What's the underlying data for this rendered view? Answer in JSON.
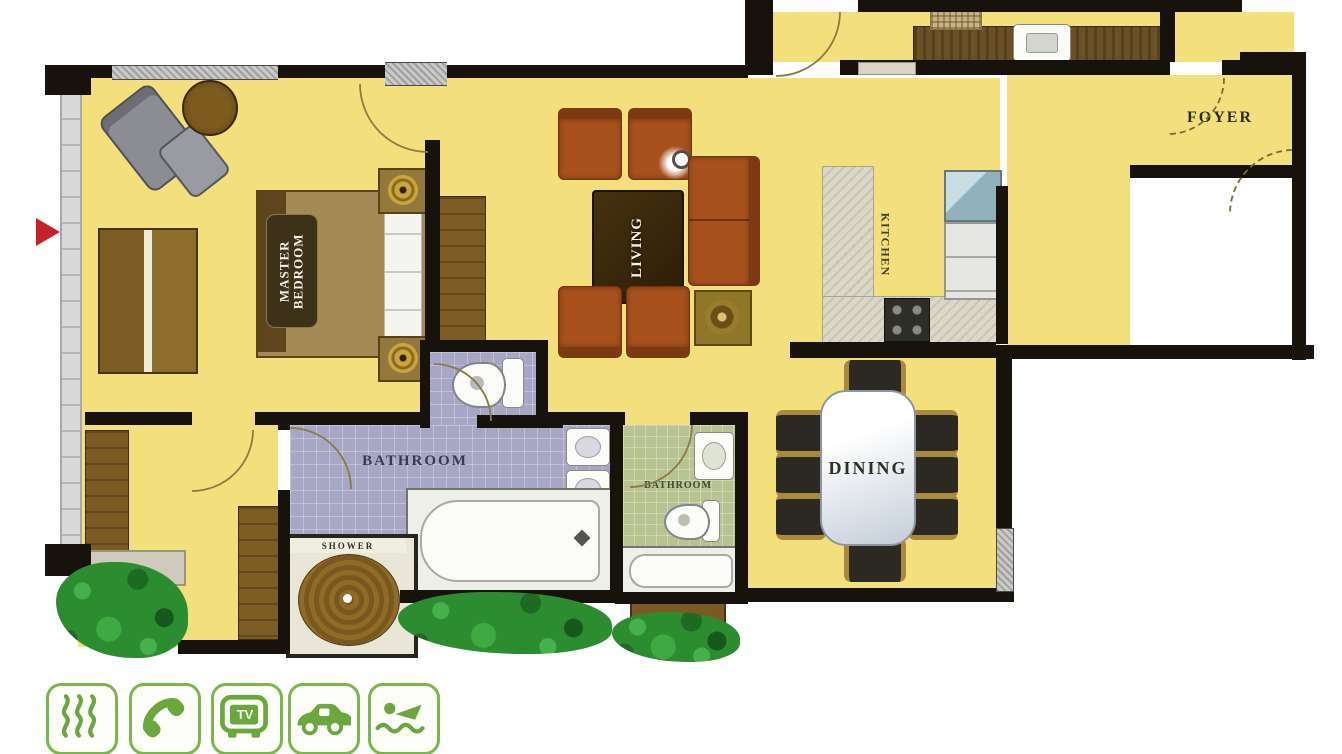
{
  "plan": {
    "rooms": {
      "master_bedroom": {
        "line1": "MASTER",
        "line2": "BEDROOM"
      },
      "living": {
        "label": "LIVING"
      },
      "kitchen": {
        "label": "KITCHEN"
      },
      "foyer": {
        "label": "FOYER"
      },
      "master_bathroom": {
        "label": "BATHROOM"
      },
      "shower": {
        "label": "SHOWER"
      },
      "common_bathroom": {
        "label": "BATHROOM"
      },
      "dining": {
        "label": "DINING"
      }
    }
  },
  "amenities": {
    "items": [
      {
        "name": "steam-sauna",
        "label": ""
      },
      {
        "name": "telephone",
        "label": ""
      },
      {
        "name": "television",
        "label": "TV"
      },
      {
        "name": "car-parking",
        "label": ""
      },
      {
        "name": "swimming-pool",
        "label": ""
      }
    ]
  },
  "colors": {
    "floor": "#f3e07d",
    "wall": "#17130c",
    "bath_master_floor": "#a8a6c5",
    "bath_common_floor": "#b7c391",
    "amenity_green": "#6aa73c",
    "entry_arrow_red": "#c5232b"
  }
}
